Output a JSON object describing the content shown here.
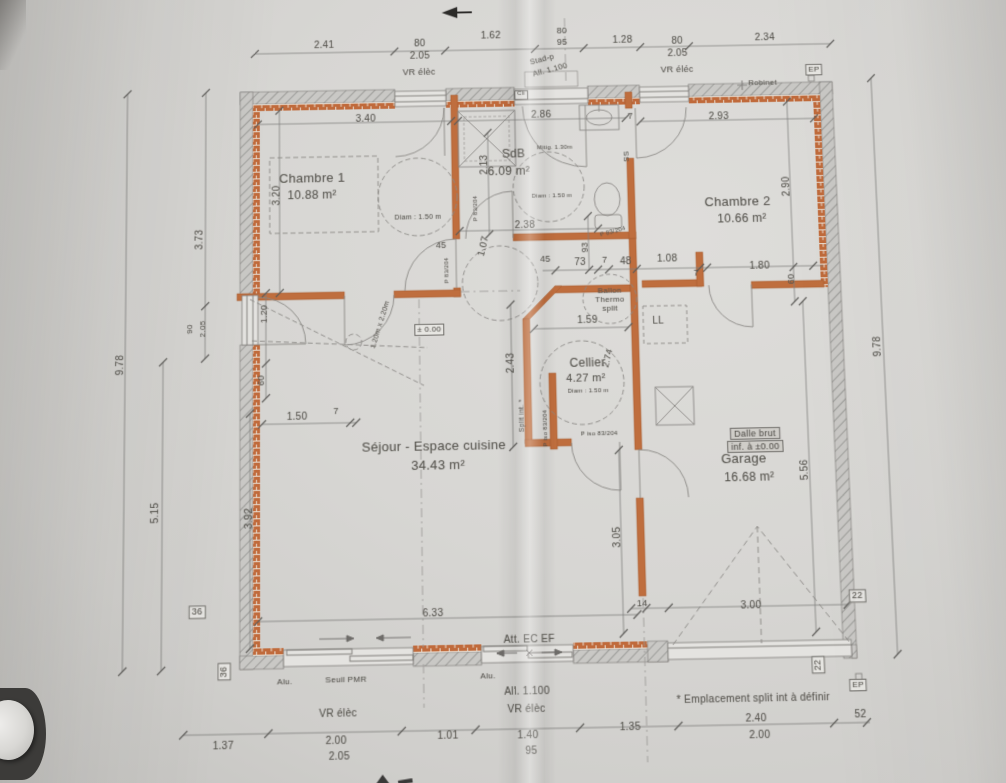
{
  "document": {
    "type": "architectural floor plan photo",
    "language": "fr"
  },
  "colors": {
    "paper": "#d7d6d3",
    "wall_hatch": "#8f8f8c",
    "wall_fill": "#c9c8c5",
    "brick_orange": "#c06a3b",
    "partition_orange": "#bf6e3e",
    "line_gray": "#82807d",
    "text_gray": "#57554f"
  },
  "rooms": [
    {
      "name": "Chambre 1",
      "area": "10.88 m²"
    },
    {
      "name": "SdB",
      "area": "6.09 m²"
    },
    {
      "name": "Chambre 2",
      "area": "10.66 m²"
    },
    {
      "name": "Cellier",
      "area": "4.27 m²"
    },
    {
      "name": "Séjour - Espace cuisine",
      "area": "34.43 m²"
    },
    {
      "name": "Garage",
      "area": "16.68 m²"
    }
  ],
  "labels": [
    {
      "i": "dim-top-241",
      "t": "2.41",
      "x": 326,
      "y": 40
    },
    {
      "i": "dim-top-80a",
      "t": "80",
      "x": 424,
      "y": 40
    },
    {
      "i": "dim-top-205a",
      "t": "2.05",
      "x": 424,
      "y": 53
    },
    {
      "i": "dim-top-162",
      "t": "1.62",
      "x": 497,
      "y": 33
    },
    {
      "i": "dim-top-80b",
      "t": "80",
      "x": 570,
      "y": 29,
      "s": 9
    },
    {
      "i": "dim-top-95b",
      "t": "95",
      "x": 570,
      "y": 41,
      "s": 9
    },
    {
      "i": "dim-top-128",
      "t": "1.28",
      "x": 632,
      "y": 40
    },
    {
      "i": "dim-top-80c",
      "t": "80",
      "x": 688,
      "y": 42
    },
    {
      "i": "dim-top-205c",
      "t": "2.05",
      "x": 688,
      "y": 55
    },
    {
      "i": "dim-top-234",
      "t": "2.34",
      "x": 778,
      "y": 40
    },
    {
      "i": "vr-elec-top-left",
      "t": "VR élèc",
      "x": 423,
      "y": 70,
      "s": 9
    },
    {
      "i": "stad-p",
      "t": "Stad-p",
      "x": 549,
      "y": 59,
      "r": -14,
      "s": 8
    },
    {
      "i": "all-1100-top",
      "t": "All. 1.100",
      "x": 557,
      "y": 70,
      "r": -14,
      "s": 8
    },
    {
      "i": "vr-elec-top-right",
      "t": "VR éléc",
      "x": 687,
      "y": 72,
      "s": 9
    },
    {
      "i": "robinet",
      "t": "Robinet",
      "x": 774,
      "y": 87,
      "s": 8
    },
    {
      "i": "ep-top",
      "t": "EP",
      "x": 827,
      "y": 75,
      "s": 8,
      "c": "box"
    },
    {
      "i": "cli-tag",
      "t": "Cli",
      "x": 527,
      "y": 96,
      "s": 6,
      "c": "box"
    },
    {
      "i": "dim-left-373",
      "t": "3.73",
      "x": 199,
      "y": 240,
      "r": -90
    },
    {
      "i": "dim-left-90",
      "t": "90",
      "x": 189,
      "y": 331,
      "r": -90,
      "s": 8
    },
    {
      "i": "dim-left-205",
      "t": "2.05",
      "x": 202,
      "y": 331,
      "r": -90,
      "s": 8
    },
    {
      "i": "dim-left-978",
      "t": "9.78",
      "x": 120,
      "y": 366,
      "r": -90
    },
    {
      "i": "dim-left-515",
      "t": "5.15",
      "x": 156,
      "y": 514,
      "r": -90
    },
    {
      "i": "dim-320",
      "t": "3.20",
      "x": 277,
      "y": 196,
      "r": -90
    },
    {
      "i": "dim-120",
      "t": "1.20",
      "x": 264,
      "y": 317,
      "r": -90,
      "s": 9
    },
    {
      "i": "dim-60-left",
      "t": "60",
      "x": 261,
      "y": 384,
      "r": -90,
      "s": 9
    },
    {
      "i": "dim-392",
      "t": "3.92",
      "x": 249,
      "y": 521,
      "r": -90
    },
    {
      "i": "dim-150",
      "t": "1.50",
      "x": 297,
      "y": 421
    },
    {
      "i": "dim-7-left",
      "t": "7",
      "x": 336,
      "y": 416,
      "s": 9
    },
    {
      "i": "box-36a",
      "t": "36",
      "x": 198,
      "y": 612,
      "s": 9,
      "c": "box"
    },
    {
      "i": "box-36b",
      "t": "36",
      "x": 225,
      "y": 670,
      "r": -90,
      "s": 9,
      "c": "box"
    },
    {
      "i": "dim-right-290",
      "t": "2.90",
      "x": 794,
      "y": 196,
      "r": -90
    },
    {
      "i": "dim-60-right",
      "t": "60",
      "x": 795,
      "y": 291,
      "r": -90,
      "s": 9
    },
    {
      "i": "dim-right-978",
      "t": "9.78",
      "x": 879,
      "y": 361,
      "r": -90
    },
    {
      "i": "dim-556",
      "t": "5.56",
      "x": 801,
      "y": 483,
      "r": -90
    },
    {
      "i": "box-22a",
      "t": "22",
      "x": 848,
      "y": 608,
      "s": 9,
      "c": "box"
    },
    {
      "i": "box-22b",
      "t": "22",
      "x": 807,
      "y": 674,
      "r": -90,
      "s": 9,
      "c": "box"
    },
    {
      "i": "ep-bottom",
      "t": "EP",
      "x": 845,
      "y": 694,
      "s": 8,
      "c": "box"
    },
    {
      "i": "dalle-brut-line1",
      "t": "Dalle brut",
      "x": 753,
      "y": 446,
      "s": 9,
      "c": "shadedbox"
    },
    {
      "i": "dalle-brut-line2",
      "t": "inf. à ±0.00",
      "x": 753,
      "y": 459,
      "s": 9,
      "c": "shadedbox"
    },
    {
      "i": "dim-633",
      "t": "6.33",
      "x": 430,
      "y": 617
    },
    {
      "i": "dim-14",
      "t": "14",
      "x": 636,
      "y": 611,
      "s": 9
    },
    {
      "i": "dim-300",
      "t": "3.00",
      "x": 743,
      "y": 615
    },
    {
      "i": "att-ec-ef",
      "t": "Att. EC EF",
      "x": 524,
      "y": 644
    },
    {
      "i": "alu-a",
      "t": "Alu.",
      "x": 284,
      "y": 680,
      "s": 8
    },
    {
      "i": "seuil-pmr",
      "t": "Seuil PMR",
      "x": 344,
      "y": 679,
      "s": 8
    },
    {
      "i": "alu-b",
      "t": "Alu.",
      "x": 483,
      "y": 678,
      "s": 8
    },
    {
      "i": "all-1100-bottom",
      "t": "All. 1.100",
      "x": 521,
      "y": 694
    },
    {
      "i": "vr-elec-bottom-1",
      "t": "VR élèc",
      "x": 336,
      "y": 712
    },
    {
      "i": "vr-elec-bottom-2",
      "t": "VR élèc",
      "x": 520,
      "y": 711
    },
    {
      "i": "emplacement-split",
      "t": "* Emplacement split int à définir",
      "x": 742,
      "y": 705
    },
    {
      "i": "dim-bot-137",
      "t": "1.37",
      "x": 224,
      "y": 741
    },
    {
      "i": "dim-bot-200a",
      "t": "2.00",
      "x": 334,
      "y": 738
    },
    {
      "i": "dim-bot-205",
      "t": "2.05",
      "x": 337,
      "y": 753
    },
    {
      "i": "dim-bot-101",
      "t": "1.01",
      "x": 443,
      "y": 735
    },
    {
      "i": "dim-bot-140",
      "t": "1.40",
      "x": 521,
      "y": 736
    },
    {
      "i": "dim-bot-95",
      "t": "95",
      "x": 524,
      "y": 751
    },
    {
      "i": "dim-bot-135",
      "t": "1.35",
      "x": 621,
      "y": 730
    },
    {
      "i": "dim-bot-240",
      "t": "2.40",
      "x": 744,
      "y": 724
    },
    {
      "i": "dim-bot-200b",
      "t": "2.00",
      "x": 747,
      "y": 740
    },
    {
      "i": "dim-bot-52",
      "t": "52",
      "x": 846,
      "y": 722
    },
    {
      "i": "room-chambre1",
      "t": "Chambre 1",
      "x": 313,
      "y": 178,
      "s": 13
    },
    {
      "i": "room-chambre1-area",
      "t": "10.88 m²",
      "x": 313,
      "y": 196,
      "s": 12
    },
    {
      "i": "diam-chambre1",
      "t": "Diam : 1.50 m",
      "x": 420,
      "y": 221,
      "s": 7
    },
    {
      "i": "room-sdb",
      "t": "SdB",
      "x": 518,
      "y": 157,
      "s": 12
    },
    {
      "i": "room-sdb-area",
      "t": "6.09 m²",
      "x": 513,
      "y": 175,
      "s": 12
    },
    {
      "i": "mitig",
      "t": "Mitig. 1.30m",
      "x": 560,
      "y": 152,
      "s": 6
    },
    {
      "i": "diam-sdb",
      "t": "Diam : 1.50 m",
      "x": 556,
      "y": 202,
      "s": 6
    },
    {
      "i": "room-chambre2",
      "t": "Chambre 2",
      "x": 744,
      "y": 210,
      "s": 13
    },
    {
      "i": "room-chambre2-area",
      "t": "10.66 m²",
      "x": 748,
      "y": 228,
      "s": 12
    },
    {
      "i": "dim-340",
      "t": "3.40",
      "x": 368,
      "y": 118
    },
    {
      "i": "dim-286",
      "t": "2.86",
      "x": 547,
      "y": 117
    },
    {
      "i": "dim-293",
      "t": "2.93",
      "x": 728,
      "y": 122
    },
    {
      "i": "dim-213",
      "t": "2.13",
      "x": 488,
      "y": 168,
      "r": -90
    },
    {
      "i": "dim-238",
      "t": "2.38",
      "x": 528,
      "y": 231
    },
    {
      "i": "dim-107",
      "t": "1.07",
      "x": 486,
      "y": 252,
      "r": -75
    },
    {
      "i": "dim-45a",
      "t": "45",
      "x": 443,
      "y": 250,
      "s": 9
    },
    {
      "i": "dim-45b",
      "t": "45",
      "x": 548,
      "y": 266,
      "s": 9
    },
    {
      "i": "dim-73",
      "t": "73",
      "x": 583,
      "y": 270
    },
    {
      "i": "dim-7a",
      "t": "7",
      "x": 608,
      "y": 268,
      "s": 9
    },
    {
      "i": "dim-48",
      "t": "48",
      "x": 629,
      "y": 270
    },
    {
      "i": "dim-108",
      "t": "1.08",
      "x": 671,
      "y": 268
    },
    {
      "i": "dim-7b",
      "t": "7",
      "x": 700,
      "y": 283,
      "s": 9
    },
    {
      "i": "dim-180",
      "t": "1.80",
      "x": 764,
      "y": 277
    },
    {
      "i": "dim-93",
      "t": "93",
      "x": 588,
      "y": 255,
      "r": -90,
      "s": 9
    },
    {
      "i": "dim-ss",
      "t": "SS",
      "x": 632,
      "y": 162,
      "r": -90,
      "s": 8
    },
    {
      "i": "dim-7c",
      "t": "7",
      "x": 638,
      "y": 120,
      "s": 9
    },
    {
      "i": "porte-83-204-a",
      "t": "P 83/204",
      "x": 479,
      "y": 213,
      "r": -90,
      "s": 6
    },
    {
      "i": "porte-83-204-b",
      "t": "P 83/204",
      "x": 617,
      "y": 240,
      "r": -15,
      "s": 6
    },
    {
      "i": "porte-83-204-c",
      "t": "P 83/204",
      "x": 449,
      "y": 276,
      "r": -90,
      "s": 6
    },
    {
      "i": "porte-iso-83-204-a",
      "t": "P iso 83/204",
      "x": 545,
      "y": 437,
      "r": -90,
      "s": 6
    },
    {
      "i": "porte-iso-83-204-b",
      "t": "P iso 83/204",
      "x": 598,
      "y": 444,
      "s": 6
    },
    {
      "i": "split-int",
      "t": "Split int. *",
      "x": 521,
      "y": 424,
      "r": -90,
      "s": 7
    },
    {
      "i": "niveau-000",
      "t": "± 0.00",
      "x": 430,
      "y": 336,
      "s": 8,
      "c": "box"
    },
    {
      "i": "trappe-120x220",
      "t": "1.20m x 2.20m",
      "x": 381,
      "y": 330,
      "r": -72,
      "s": 7
    },
    {
      "i": "ballon-line1",
      "t": "Ballon",
      "x": 612,
      "y": 299,
      "s": 8
    },
    {
      "i": "ballon-line2",
      "t": "Thermo",
      "x": 612,
      "y": 308,
      "s": 8
    },
    {
      "i": "ballon-line3",
      "t": "split",
      "x": 612,
      "y": 317,
      "s": 8
    },
    {
      "i": "ll-lave-linge",
      "t": "LL",
      "x": 660,
      "y": 331
    },
    {
      "i": "dim-159",
      "t": "1.59",
      "x": 589,
      "y": 329
    },
    {
      "i": "dim-274",
      "t": "2.74",
      "x": 608,
      "y": 368,
      "r": -75,
      "s": 9
    },
    {
      "i": "dim-243",
      "t": "2.43",
      "x": 511,
      "y": 371,
      "r": -90
    },
    {
      "i": "room-cellier",
      "t": "Cellier",
      "x": 588,
      "y": 372,
      "s": 12
    },
    {
      "i": "room-cellier-area",
      "t": "4.27 m²",
      "x": 586,
      "y": 388,
      "s": 11
    },
    {
      "i": "diam-cellier",
      "t": "Diam : 1.50 m",
      "x": 588,
      "y": 401,
      "s": 6
    },
    {
      "i": "room-sejour",
      "t": "Séjour - Espace cuisine",
      "x": 433,
      "y": 452,
      "s": 13
    },
    {
      "i": "room-sejour-area",
      "t": "34.43 m²",
      "x": 437,
      "y": 471,
      "s": 13
    },
    {
      "i": "room-garage",
      "t": "Garage",
      "x": 741,
      "y": 470,
      "s": 13
    },
    {
      "i": "room-garage-area",
      "t": "16.68 m²",
      "x": 746,
      "y": 489,
      "s": 12
    },
    {
      "i": "dim-305",
      "t": "3.05",
      "x": 613,
      "y": 546,
      "r": -90
    }
  ]
}
